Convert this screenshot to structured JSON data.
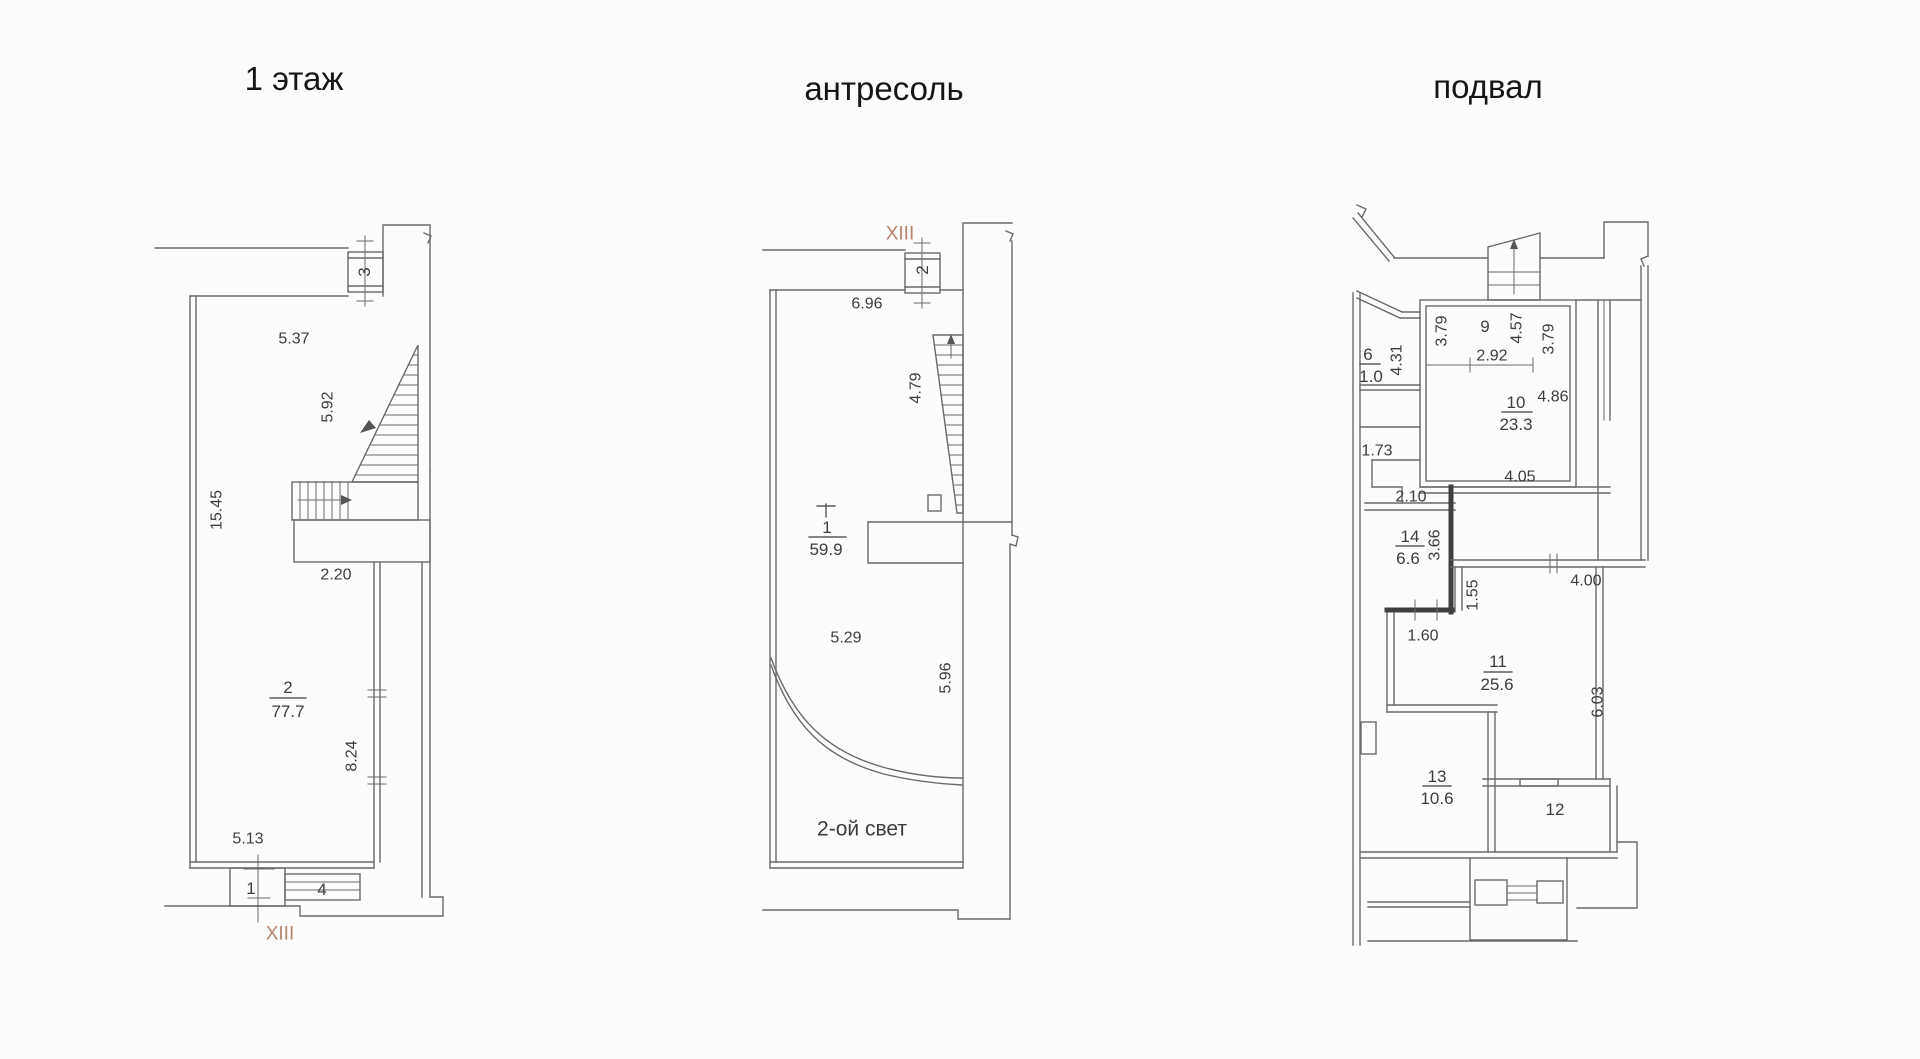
{
  "colors": {
    "wall_line": "#6a6a6a",
    "wall_dark": "#3f3f3f",
    "text": "#3c3c3c",
    "section_mark_color": "#b5826e"
  },
  "floor1": {
    "title": "1 этаж",
    "section_mark": "XIII",
    "rooms": {
      "r1": {
        "number": "1"
      },
      "r2": {
        "number": "2",
        "area": "77.7"
      },
      "r3": {
        "number": "3"
      },
      "r4": {
        "number": "4"
      }
    },
    "dims": {
      "top_width": "5.37",
      "stair_run": "5.92",
      "left_height": "15.45",
      "landing_width": "2.20",
      "right_height": "8.24",
      "bottom_width": "5.13"
    }
  },
  "mezzanine": {
    "title": "антресоль",
    "section_mark": "XIII",
    "rooms": {
      "r1": {
        "number": "1",
        "area": "59.9"
      },
      "r2": {
        "number": "2"
      }
    },
    "dims": {
      "top_width": "6.96",
      "stair_height": "4.79",
      "mid_width": "5.29",
      "right_height": "5.96"
    },
    "void_label": "2-ой свет"
  },
  "basement": {
    "title": "подвал",
    "rooms": {
      "r6": {
        "number": "6",
        "area": "1.0"
      },
      "r9": {
        "number": "9"
      },
      "r10": {
        "number": "10",
        "area": "23.3"
      },
      "r11": {
        "number": "11",
        "area": "25.6"
      },
      "r12": {
        "number": "12"
      },
      "r13": {
        "number": "13",
        "area": "10.6"
      },
      "r14": {
        "number": "14",
        "area": "6.6"
      }
    },
    "dims": {
      "r9_left": "3.79",
      "r9_stair": "4.57",
      "r9_width": "2.92",
      "r9_right": "3.79",
      "left_431": "4.31",
      "r10_top": "4.86",
      "left_173": "1.73",
      "r10_bottom": "4.05",
      "landing": "2.10",
      "r14_right": "3.66",
      "corridor_155": "1.55",
      "r11_top": "4.00",
      "r14_door": "1.60",
      "r11_right": "6.03"
    }
  }
}
